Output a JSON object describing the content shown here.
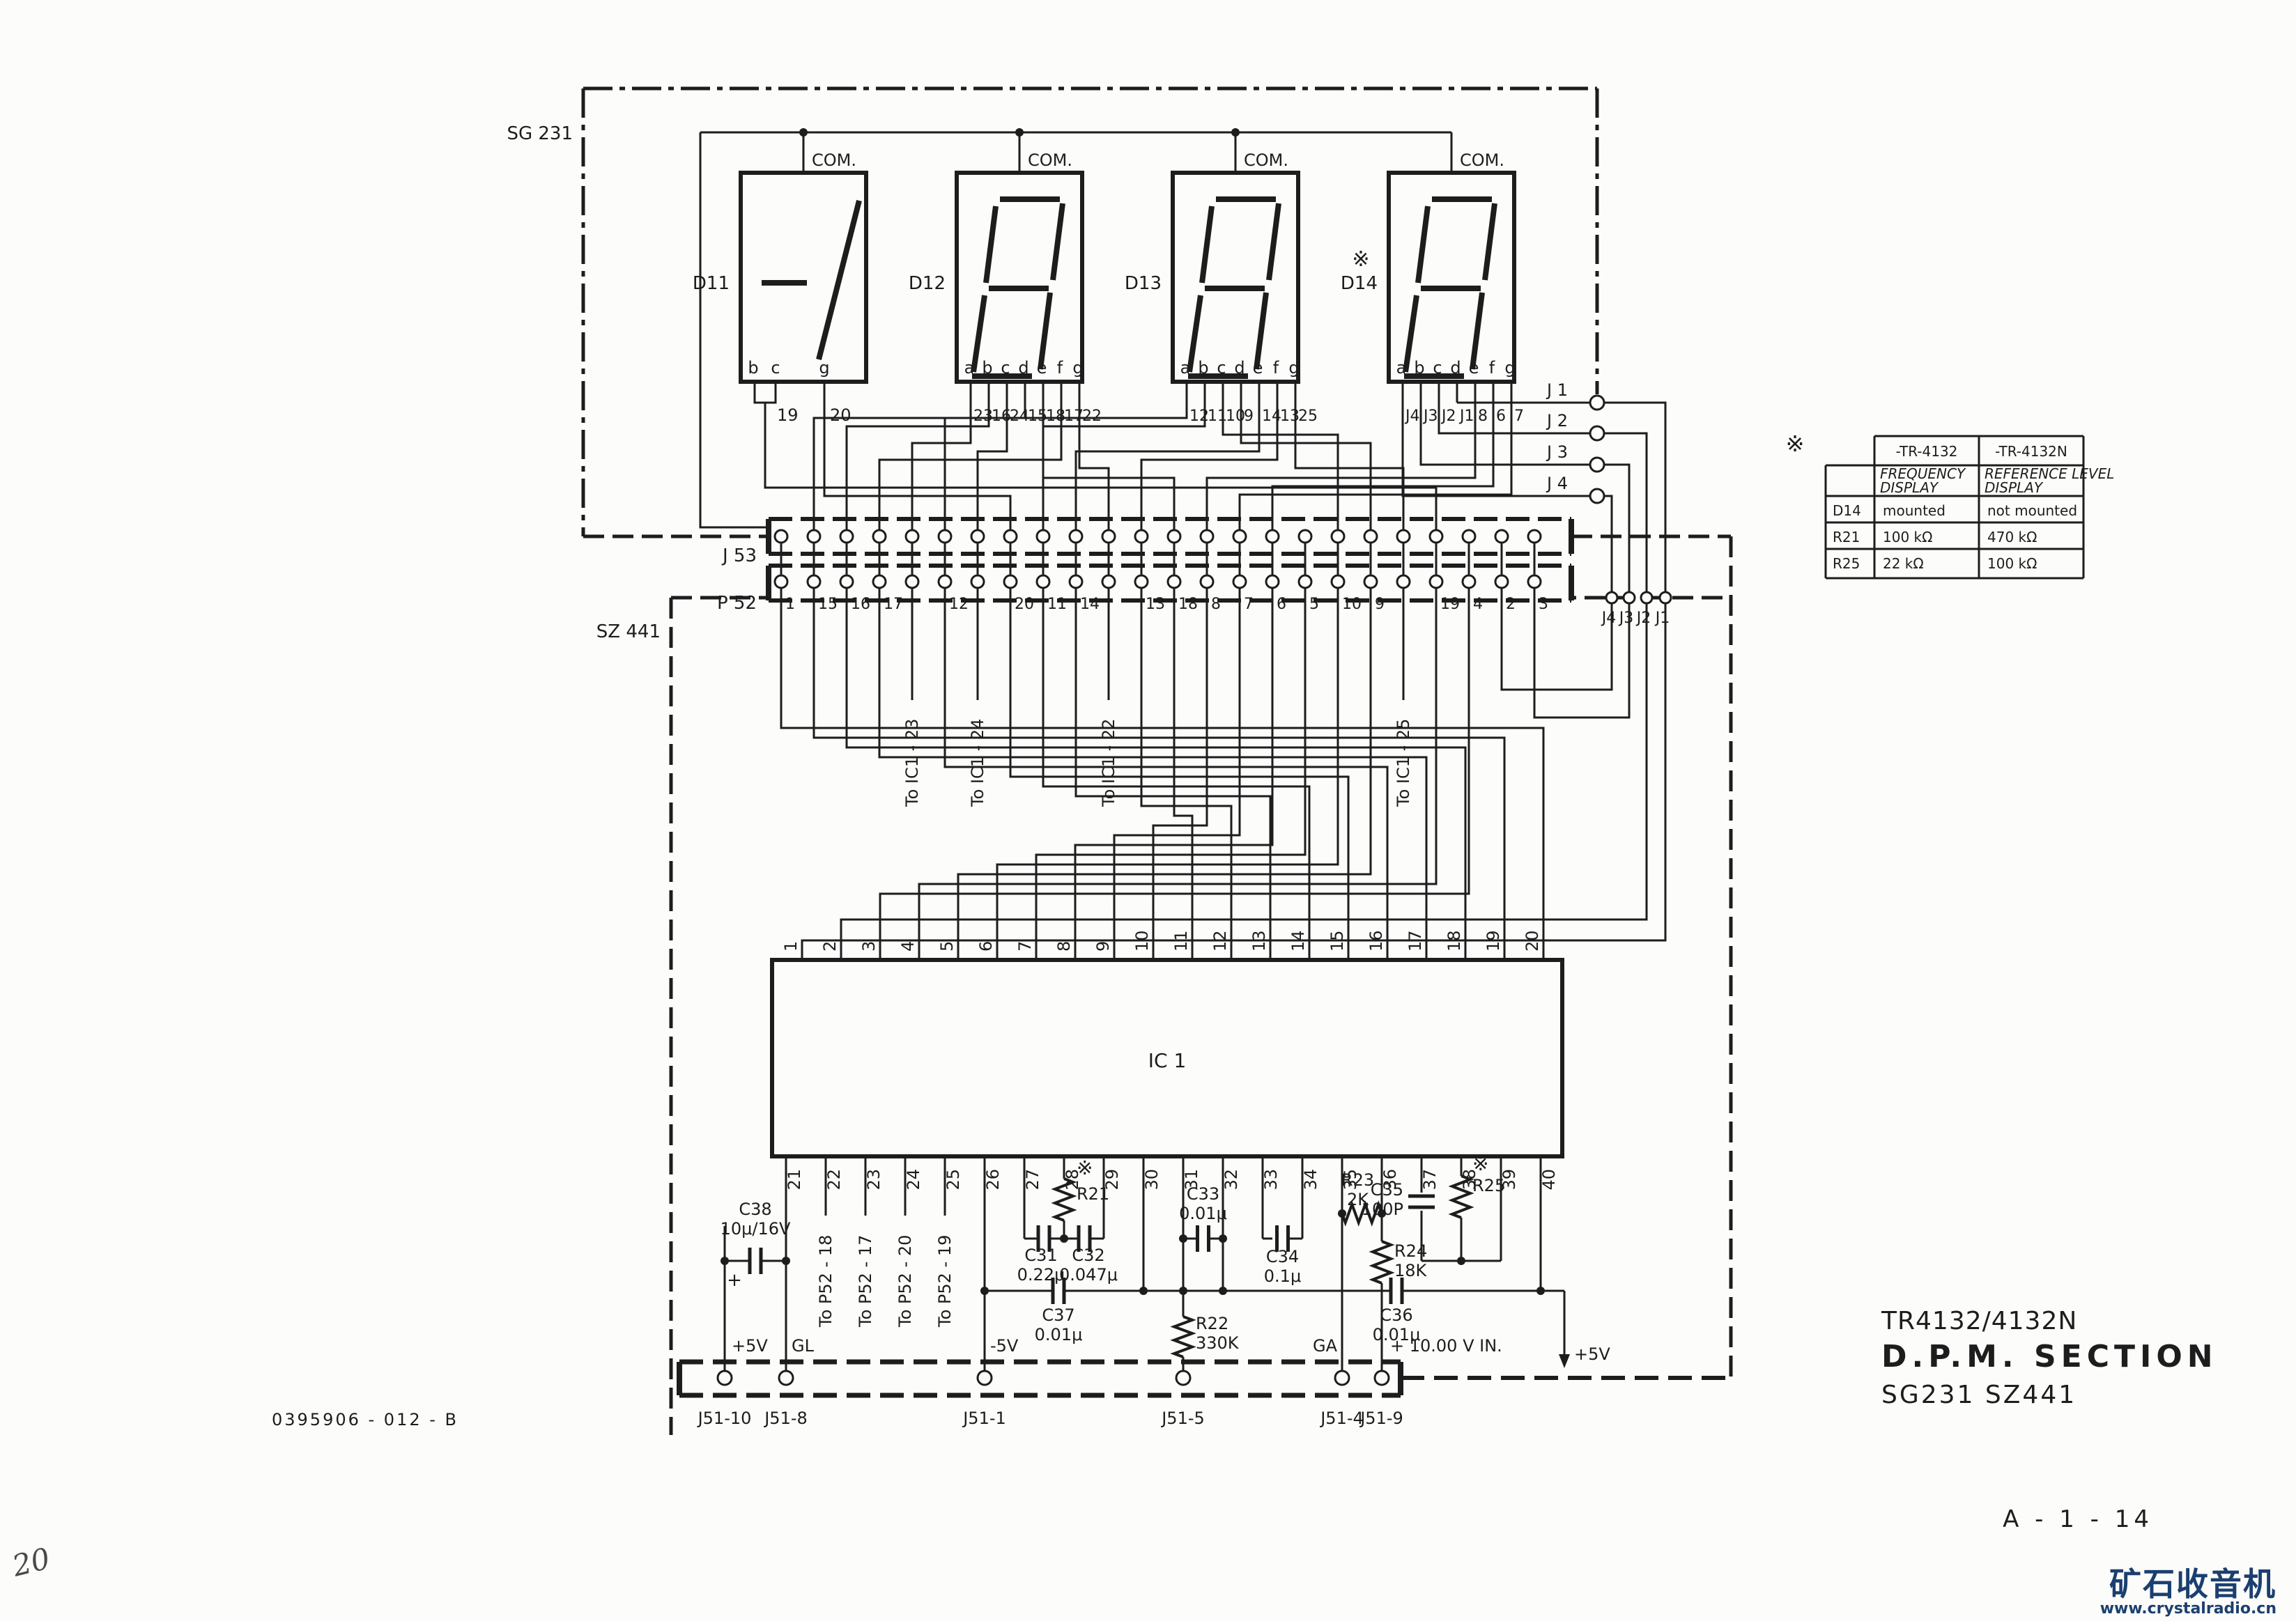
{
  "page": {
    "doc_number": "0395906 - 012 - B",
    "page_number": "A - 1 - 14",
    "handwritten_note": "20"
  },
  "title_block": {
    "model": "TR4132/4132N",
    "section": "D.P.M. SECTION",
    "boards": "SG231 SZ441"
  },
  "watermark": {
    "name": "矿石收音机",
    "url": "www.crystalradio.cn",
    "color": "#1b3f70"
  },
  "board_labels": {
    "sg231": "SG 231",
    "sz441": "SZ 441"
  },
  "displays": [
    {
      "ref": "D11",
      "com": "COM.",
      "marker": "",
      "seg_letters": [
        "b",
        "c",
        "g"
      ],
      "pin_labels": [
        "19",
        "20"
      ]
    },
    {
      "ref": "D12",
      "com": "COM.",
      "marker": "",
      "seg_letters": [
        "a",
        "b",
        "c",
        "d",
        "e",
        "f",
        "g"
      ],
      "pin_labels": [
        "23",
        "16",
        "24",
        "15",
        "18",
        "17",
        "22"
      ]
    },
    {
      "ref": "D13",
      "com": "COM.",
      "marker": "",
      "seg_letters": [
        "a",
        "b",
        "c",
        "d",
        "e",
        "f",
        "g"
      ],
      "pin_labels": [
        "12",
        "11",
        "10",
        "9",
        "14",
        "13",
        "25"
      ]
    },
    {
      "ref": "D14",
      "com": "COM.",
      "marker": "※",
      "seg_letters": [
        "a",
        "b",
        "c",
        "d",
        "e",
        "f",
        "g"
      ],
      "pin_labels": [
        "J4",
        "J3",
        "J2",
        "J1",
        "8",
        "6",
        "7"
      ]
    }
  ],
  "connectors": {
    "j53": {
      "label": "J 53"
    },
    "p52": {
      "label": "P 52",
      "pin_numbers": [
        "1",
        "15",
        "16",
        "17",
        "12",
        "20",
        "11",
        "14",
        "13",
        "18",
        "8",
        "7",
        "6",
        "5",
        "10",
        "9",
        "19",
        "4",
        "2",
        "3"
      ],
      "right_pin_labels": [
        "J4",
        "J3",
        "J2",
        "J1"
      ]
    },
    "j51": {
      "pin_labels": [
        "J51-10",
        "J51-8",
        "J51-1",
        "J51-5",
        "J51-4",
        "J51-9"
      ]
    }
  },
  "jumpers": {
    "labels": [
      "J 1",
      "J 2",
      "J 3",
      "J 4"
    ]
  },
  "net_stubs": {
    "to_ic1": [
      "To IC1 - 23",
      "To IC1 - 24",
      "To IC1 - 22",
      "To IC1 - 25"
    ],
    "to_p52": [
      "To P52 - 18",
      "To P52 - 17",
      "To P52 - 20",
      "To P52 - 19"
    ]
  },
  "ic": {
    "ref": "IC 1",
    "top_pins": [
      "20",
      "19",
      "18",
      "17",
      "16",
      "15",
      "14",
      "13",
      "12",
      "11",
      "10",
      "9",
      "8",
      "7",
      "6",
      "5",
      "4",
      "3",
      "2",
      "1"
    ],
    "bottom_pins": [
      "21",
      "22",
      "23",
      "24",
      "25",
      "26",
      "27",
      "28",
      "29",
      "30",
      "31",
      "32",
      "33",
      "34",
      "35",
      "36",
      "37",
      "38",
      "39",
      "40"
    ]
  },
  "power": {
    "p5_left": "+5V",
    "gl": "GL",
    "m5": "-5V",
    "ga": "GA",
    "vin": "+ 10.00 V IN.",
    "p5_right": "+5V"
  },
  "components": {
    "c38": {
      "ref": "C38",
      "value": "10μ/16V",
      "polarity": "+"
    },
    "r21": {
      "ref": "R21",
      "marker": "※"
    },
    "c31": {
      "ref": "C31",
      "value": "0.22μ"
    },
    "c32": {
      "ref": "C32",
      "value": "0.047μ"
    },
    "c33": {
      "ref": "C33",
      "value": "0.01μ"
    },
    "c34": {
      "ref": "C34",
      "value": "0.1μ"
    },
    "c35": {
      "ref": "C35",
      "value": "100P"
    },
    "c36": {
      "ref": "C36",
      "value": "0.01μ"
    },
    "c37": {
      "ref": "C37",
      "value": "0.01μ"
    },
    "r22": {
      "ref": "R22",
      "value": "330K"
    },
    "r23": {
      "ref": "R23",
      "value": "2K"
    },
    "r24": {
      "ref": "R24",
      "value": "18K"
    },
    "r25": {
      "ref": "R25",
      "marker": "※"
    }
  },
  "variant_table": {
    "marker": "※",
    "col_headers": [
      "-TR-4132",
      "-TR-4132N"
    ],
    "sub_headers": [
      [
        "FREQUENCY",
        "DISPLAY"
      ],
      [
        "REFERENCE LEVEL",
        "DISPLAY"
      ]
    ],
    "rows": [
      {
        "ref": "D14",
        "v1": "mounted",
        "v2": "not mounted"
      },
      {
        "ref": "R21",
        "v1": "100 kΩ",
        "v2": "470 kΩ"
      },
      {
        "ref": "R25",
        "v1": "22 kΩ",
        "v2": "100 kΩ"
      }
    ]
  }
}
